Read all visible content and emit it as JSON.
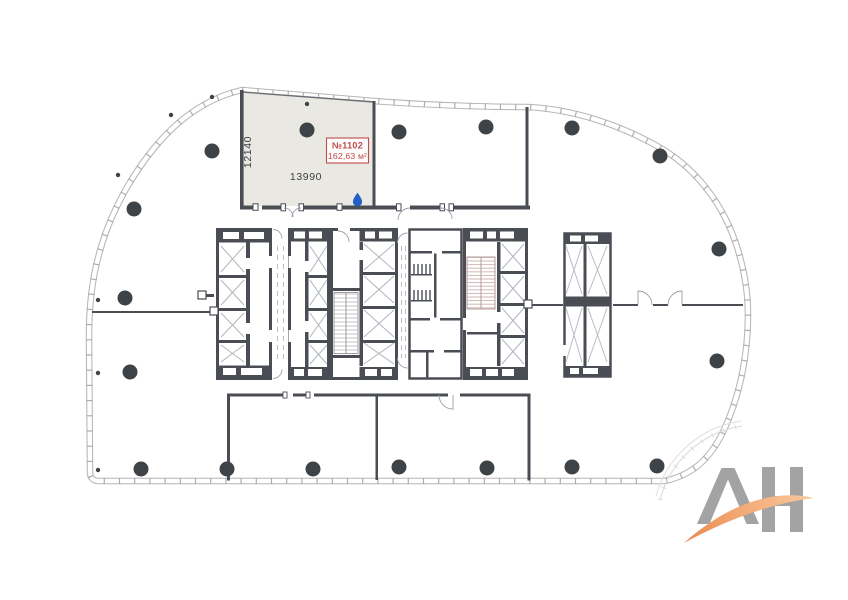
{
  "floor_plan": {
    "unit": {
      "number": "№1102",
      "area": "162,63 м²"
    },
    "dimensions": {
      "width": "13990",
      "height": "12140"
    },
    "icons": {
      "wet_point": "water-drop-icon"
    },
    "colors": {
      "unit_fill": "#EAE8E2",
      "unit_label_red": "#C04A4A",
      "walls_dark": "#4A4E54",
      "facade_gray": "#B6B6B6",
      "column_dark": "#3E4347",
      "water_drop_blue": "#2160C4"
    }
  },
  "logo": {
    "letters": "АН",
    "colors": {
      "letters_gray": "#A3A3A3",
      "swoosh_orange": "#F2A673"
    }
  }
}
